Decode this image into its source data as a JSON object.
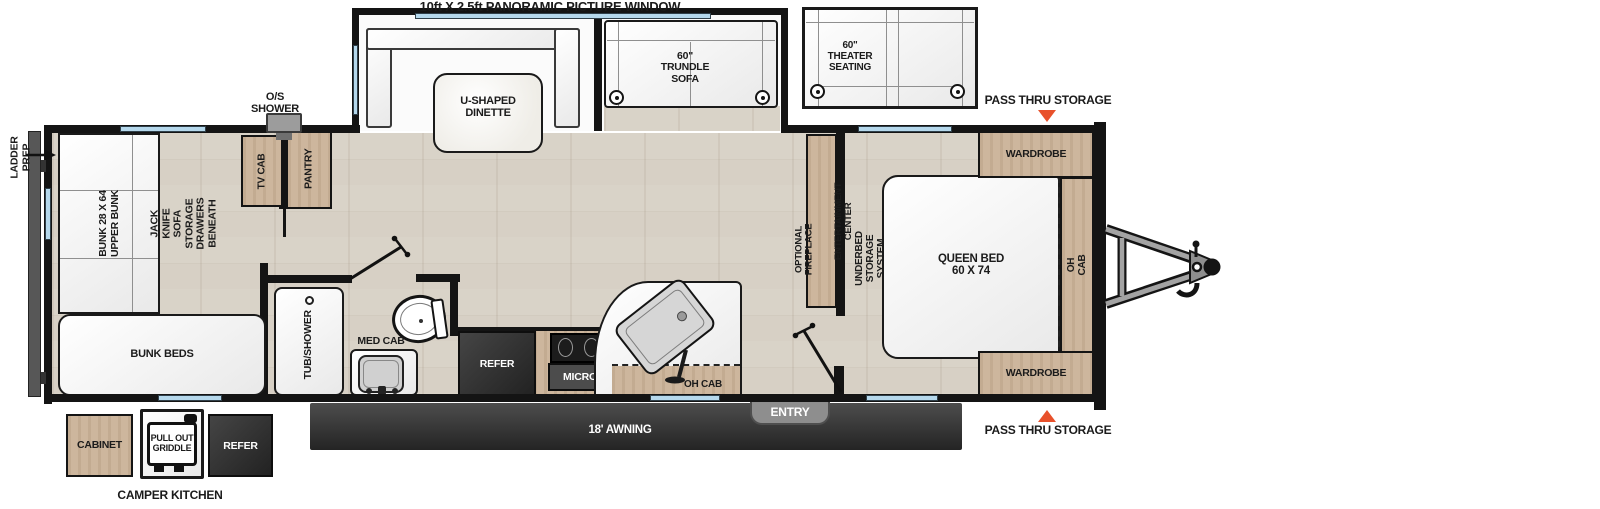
{
  "labels": {
    "panoramic_window": "10ft X 2.5ft PANORAMIC PICTURE WINDOW",
    "u_dinette": "U-SHAPED\nDINETTE",
    "trundle_sofa": "60\"\nTRUNDLE\nSOFA",
    "theater_seating": "60\"\nTHEATER\nSEATING",
    "pass_thru_top": "PASS THRU STORAGE",
    "pass_thru_bottom": "PASS THRU STORAGE",
    "wardrobe_top": "WARDROBE",
    "wardrobe_bottom": "WARDROBE",
    "queen_bed": "QUEEN BED\n60 X 74",
    "oh_cab_bedroom": "OH CAB",
    "underbed_storage": "UNDERBED STORAGE SYSTEM",
    "entertainment_center": "ENTERTAINMENT CENTER",
    "optional_fireplace": "OPTIONAL\nFIREPLACE",
    "entry": "ENTRY",
    "awning": "18' AWNING",
    "oh_cab_kitchen": "OH CAB",
    "micro": "MICRO",
    "refer": "REFER",
    "med_cab": "MED CAB",
    "tub_shower": "TUB/SHOWER",
    "os_shower": "O/S\nSHOWER",
    "tv_cab": "TV CAB",
    "pantry": "PANTRY",
    "bunk_upper": "BUNK 28 X 64\nUPPER BUNK",
    "jack_knife_sofa": "JACK KNIFE SOFA\nSTORAGE DRAWERS BENEATH",
    "bunk_beds": "BUNK BEDS",
    "ladder_prep": "LADDER\nPREP",
    "camper_kitchen": "CAMPER KITCHEN",
    "cabinet": "CABINET",
    "pull_out_griddle": "PULL OUT\nGRIDDLE",
    "camper_refer": "REFER"
  },
  "colors": {
    "accent_orange": "#e8512b",
    "wall": "#141414",
    "wood": "#cdb69d",
    "floor": "#d7d0c5",
    "window": "#b5d8ec",
    "awning": "#333333"
  }
}
